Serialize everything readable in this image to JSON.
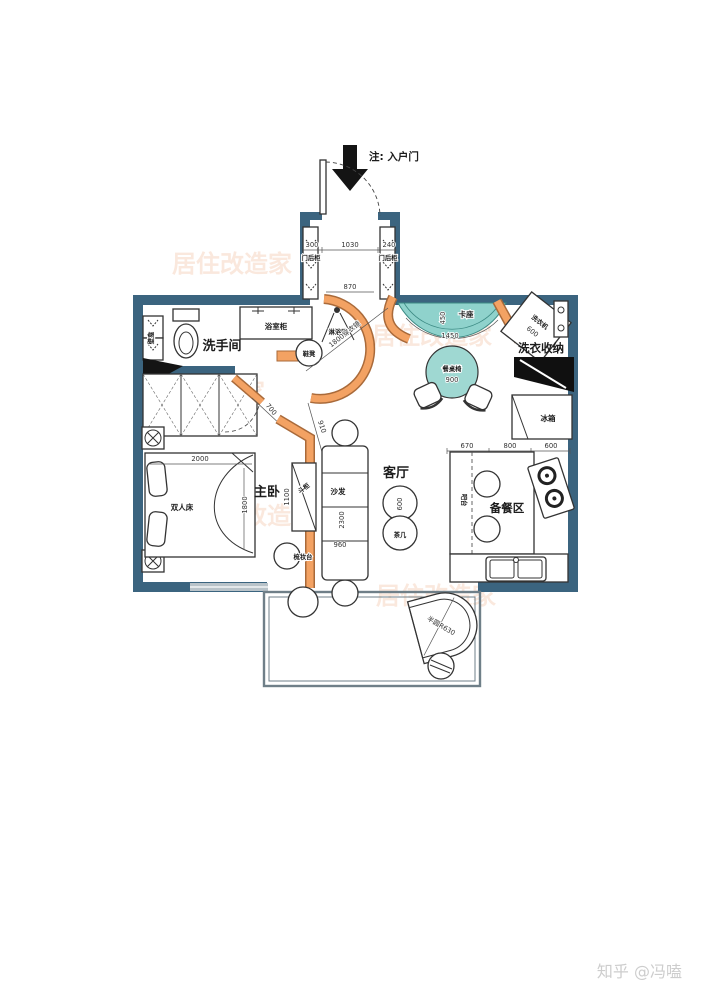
{
  "watermark": {
    "brand": "居住改造家",
    "credit": "知乎 @冯嗑"
  },
  "entrance": {
    "note": "注: 入户门",
    "dim_left": "300",
    "dim_mid": "1030",
    "dim_right": "240",
    "dim_opening": "870",
    "cabinet_left": "门后柜",
    "cabinet_right": "门后柜"
  },
  "bathroom": {
    "name": "洗手间",
    "vanity": "浴室柜",
    "shower": "淋浴区",
    "niche": "壁龛",
    "stool": "鞋凳",
    "mirror": "1800穿衣镜"
  },
  "bedroom": {
    "name": "主卧",
    "bed": "双人床",
    "bed_width": "2000",
    "bed_depth": "1800",
    "chest": "斗柜",
    "chest_dim": "1100",
    "vanity": "梳妆台",
    "door_dim": "700",
    "passage_dim": "910"
  },
  "living": {
    "name": "客厅",
    "sofa": "沙发",
    "sofa_length": "2300",
    "sofa_width": "960",
    "tea_table": "茶几",
    "tea_dim": "600"
  },
  "dining": {
    "booth": "卡座",
    "booth_dim": "450",
    "arc_dim": "1450",
    "table": "餐桌椅",
    "table_dim": "900"
  },
  "laundry": {
    "name": "洗衣收纳",
    "washer": "洗衣机",
    "washer_dim": "600",
    "fridge": "冰箱"
  },
  "kitchen": {
    "name": "备餐区",
    "bar": "吧台",
    "dim_left": "670",
    "dim_mid": "800",
    "dim_right": "600"
  },
  "balcony": {
    "desk_label": "半圆R630"
  }
}
